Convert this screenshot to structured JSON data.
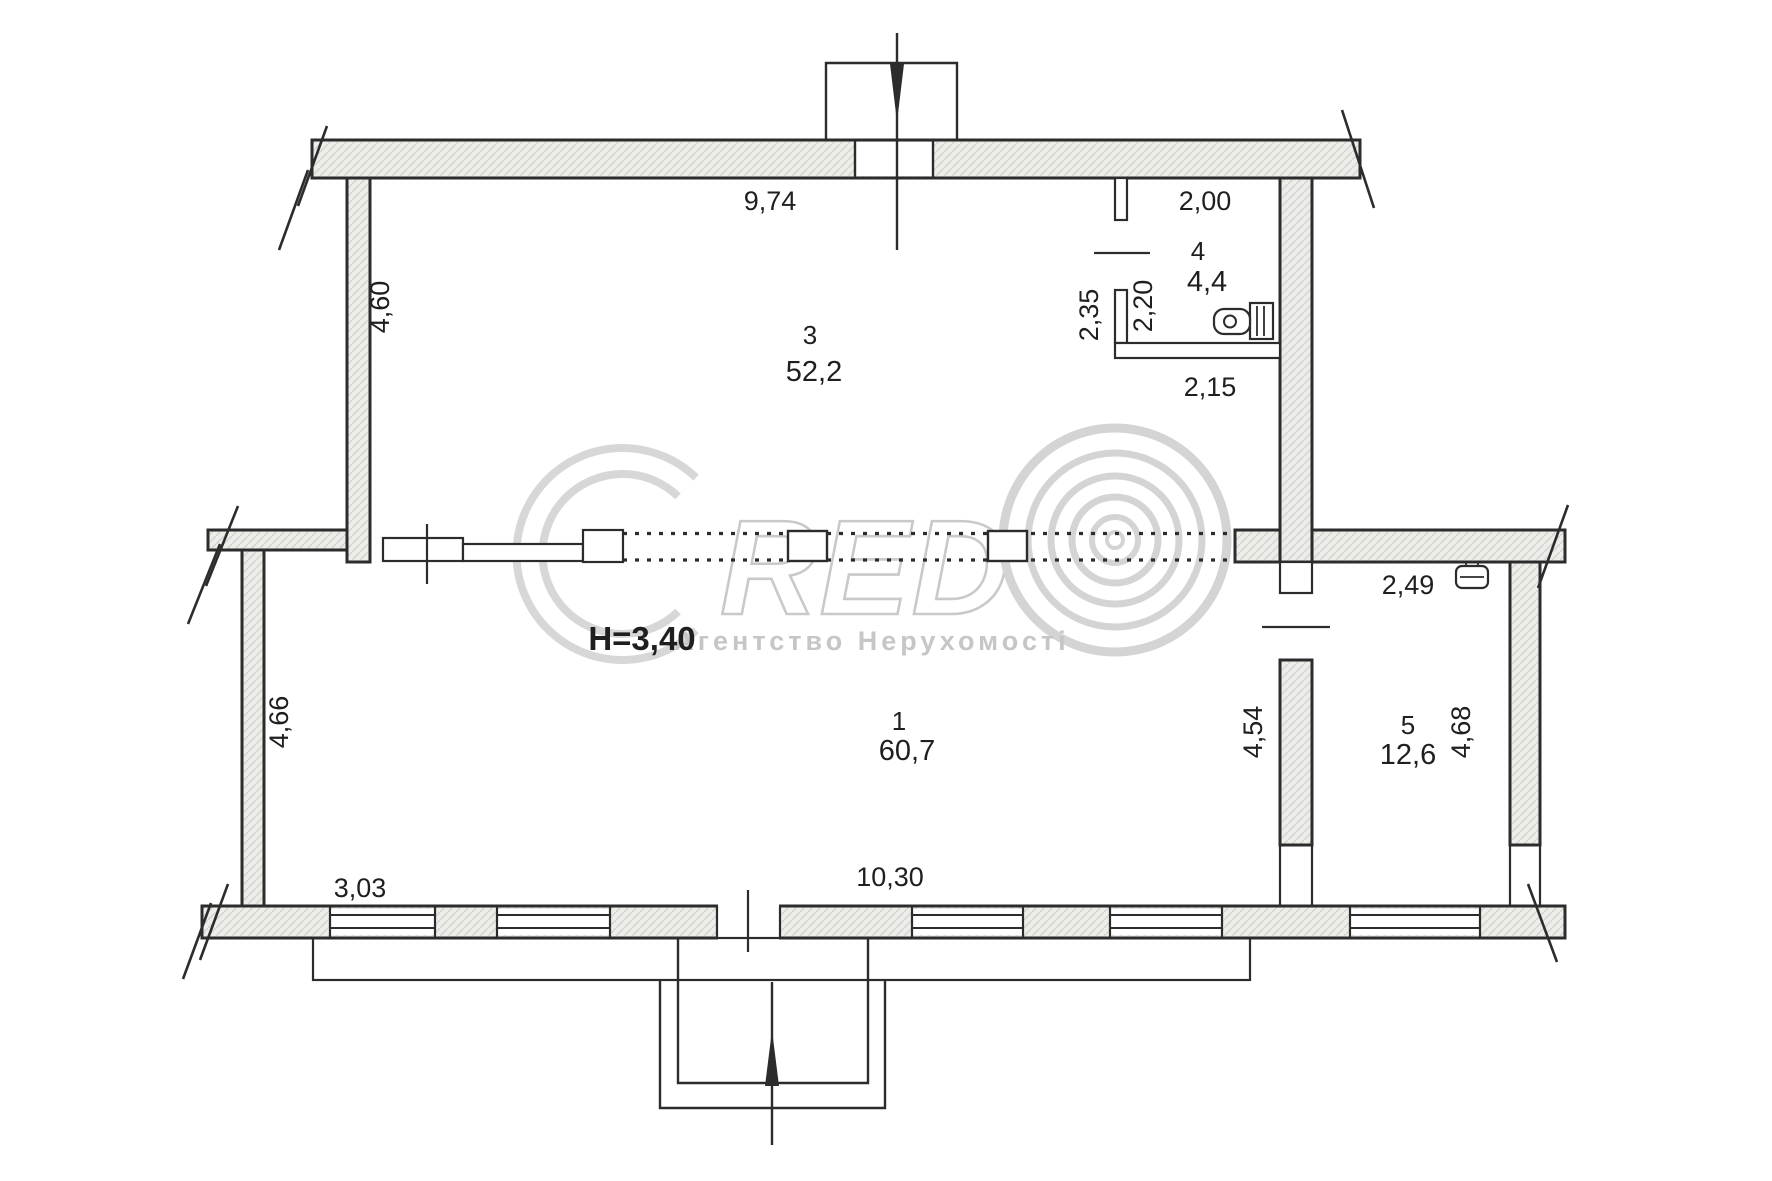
{
  "page": {
    "type": "floor-plan-scan",
    "background": "#ffffff",
    "ink": "#2c2c2c",
    "wall_fill": "#ededeb"
  },
  "watermark": {
    "letters_red": "RED",
    "agency": "Агентство Нерухомості",
    "color": "#c9c9c9"
  },
  "rooms": [
    {
      "number": "1",
      "area": "60,7"
    },
    {
      "number": "3",
      "area": "52,2"
    },
    {
      "number": "4",
      "area": "4,4"
    },
    {
      "number": "5",
      "area": "12,6"
    }
  ],
  "annotations": {
    "ceiling_height": "H=3,40"
  },
  "dimensions": {
    "room3_top_width": "9,74",
    "room3_left_height": "4,60",
    "wc_top_width": "2,00",
    "wc_left_height": "2,35",
    "wc_inner_height": "2,20",
    "wc_bottom_width": "2,15",
    "room5_top_width": "2,49",
    "room5_right_height": "4,68",
    "divider_height": "4,54",
    "room1_left_height": "4,66",
    "room1_window_left": "3,03",
    "room1_bottom_width": "10,30"
  }
}
